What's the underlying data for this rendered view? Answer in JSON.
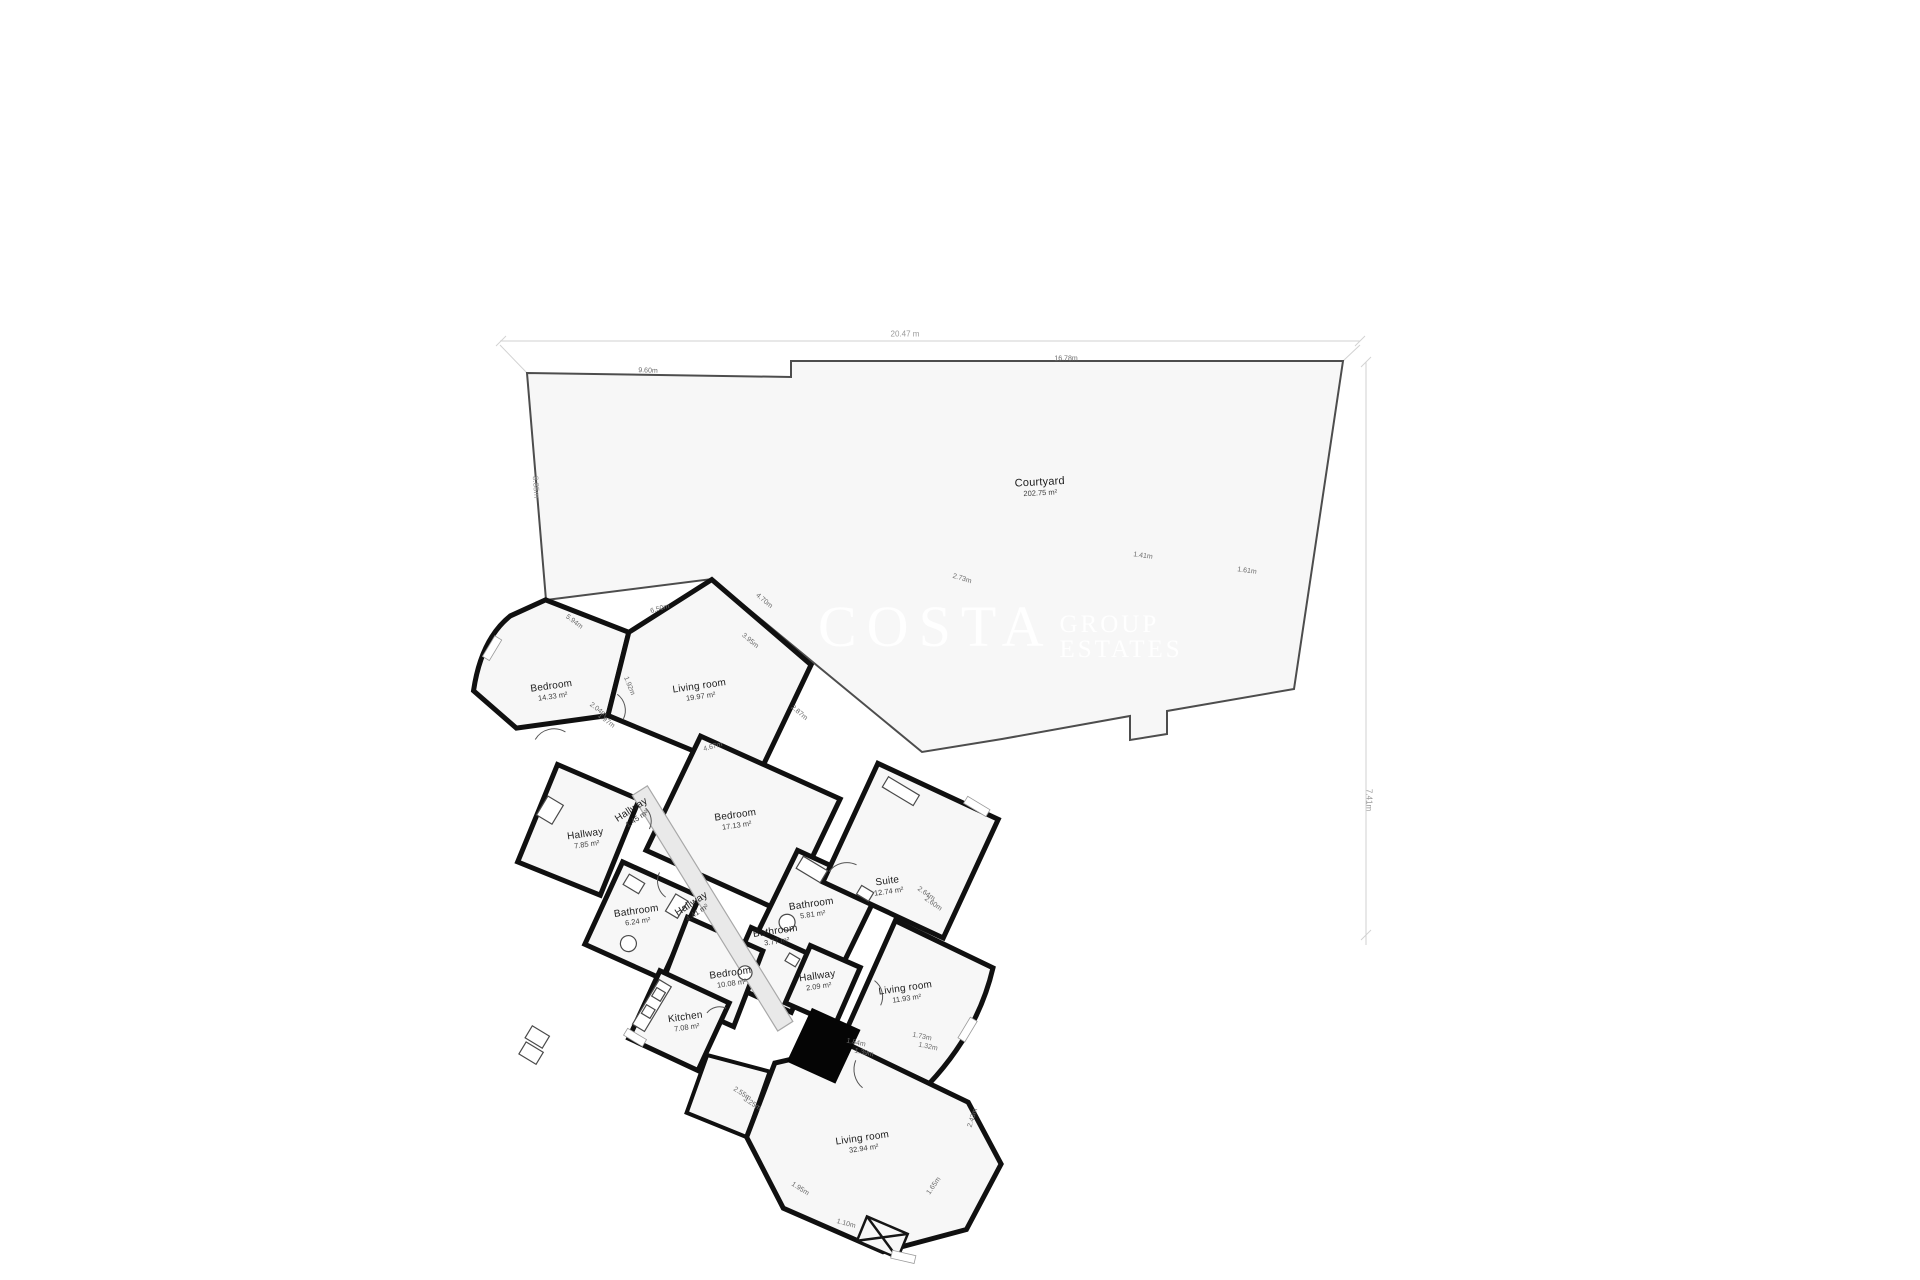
{
  "palette": {
    "background": "#ffffff",
    "plan_fill": "#f7f7f7",
    "wall_color": "#101010",
    "courtyard_outline": "#4d4d4d",
    "corridor_fill": "#e9e9e9",
    "dim_line": "#d2d2d2",
    "watermark_color": "#ffffff"
  },
  "watermark": {
    "line1": "COSTA",
    "line2": "GROUP",
    "line3": "ESTATES"
  },
  "rooms": [
    {
      "name": "Courtyard",
      "area": "202.75 m²",
      "x": 1040,
      "y": 487,
      "rot": -3,
      "big": true
    },
    {
      "name": "Bedroom",
      "area": "14.33 m²",
      "x": 552,
      "y": 691,
      "rot": -8,
      "big": false
    },
    {
      "name": "Living room",
      "area": "19.97 m²",
      "x": 700,
      "y": 691,
      "rot": -8,
      "big": false
    },
    {
      "name": "Hallway",
      "area": "7.85 m²",
      "x": 586,
      "y": 839,
      "rot": -8,
      "big": false
    },
    {
      "name": "Hallway",
      "area": "1.45 m²",
      "x": 634,
      "y": 814,
      "rot": -33,
      "big": false
    },
    {
      "name": "Bedroom",
      "area": "17.13 m²",
      "x": 736,
      "y": 820,
      "rot": -8,
      "big": false
    },
    {
      "name": "Bathroom",
      "area": "6.24 m²",
      "x": 637,
      "y": 916,
      "rot": -8,
      "big": false
    },
    {
      "name": "Hallway",
      "area": "4.41 m²",
      "x": 694,
      "y": 908,
      "rot": -33,
      "big": false
    },
    {
      "name": "Bathroom",
      "area": "5.81 m²",
      "x": 812,
      "y": 909,
      "rot": -8,
      "big": false
    },
    {
      "name": "Bathroom",
      "area": "3.77 m²",
      "x": 776,
      "y": 936,
      "rot": -8,
      "big": false
    },
    {
      "name": "Suite",
      "area": "12.74 m²",
      "x": 888,
      "y": 886,
      "rot": -8,
      "big": false
    },
    {
      "name": "Bedroom",
      "area": "10.08 m²",
      "x": 731,
      "y": 978,
      "rot": -8,
      "big": false
    },
    {
      "name": "Hallway",
      "area": "2.09 m²",
      "x": 818,
      "y": 981,
      "rot": -8,
      "big": false
    },
    {
      "name": "Living room",
      "area": "11.93 m²",
      "x": 906,
      "y": 993,
      "rot": -8,
      "big": false
    },
    {
      "name": "Kitchen",
      "area": "7.08 m²",
      "x": 686,
      "y": 1022,
      "rot": -8,
      "big": false
    },
    {
      "name": "Living room",
      "area": "32.94 m²",
      "x": 863,
      "y": 1143,
      "rot": -8,
      "big": false
    }
  ],
  "dimensions": [
    {
      "text": "20.47 m",
      "x": 905,
      "y": 334,
      "rot": 0,
      "outer": true
    },
    {
      "text": "16.78m",
      "x": 1066,
      "y": 359,
      "rot": 0,
      "outer": false
    },
    {
      "text": "9.60m",
      "x": 648,
      "y": 371,
      "rot": 2,
      "outer": false
    },
    {
      "text": "8.85m",
      "x": 536,
      "y": 487,
      "rot": 86,
      "outer": true
    },
    {
      "text": "7.41m",
      "x": 1369,
      "y": 800,
      "rot": 90,
      "outer": true
    },
    {
      "text": "1.61m",
      "x": 1247,
      "y": 571,
      "rot": 8,
      "outer": false
    },
    {
      "text": "1.41m",
      "x": 1143,
      "y": 556,
      "rot": 8,
      "outer": false
    },
    {
      "text": "2.73m",
      "x": 962,
      "y": 579,
      "rot": 17,
      "outer": false
    },
    {
      "text": "5.94m",
      "x": 574,
      "y": 622,
      "rot": 37,
      "outer": false
    },
    {
      "text": "6.50m",
      "x": 660,
      "y": 609,
      "rot": -16,
      "outer": false
    },
    {
      "text": "4.70m",
      "x": 764,
      "y": 601,
      "rot": 40,
      "outer": false
    },
    {
      "text": "3.95m",
      "x": 750,
      "y": 641,
      "rot": 40,
      "outer": false
    },
    {
      "text": "4.67m",
      "x": 713,
      "y": 747,
      "rot": -16,
      "outer": false
    },
    {
      "text": "2.87m",
      "x": 799,
      "y": 713,
      "rot": 40,
      "outer": false
    },
    {
      "text": "2.04m",
      "x": 598,
      "y": 710,
      "rot": 37,
      "outer": false
    },
    {
      "text": "1.97m",
      "x": 606,
      "y": 721,
      "rot": 37,
      "outer": false
    },
    {
      "text": "1.92m",
      "x": 629,
      "y": 686,
      "rot": 68,
      "outer": false
    },
    {
      "text": "2.64m",
      "x": 926,
      "y": 894,
      "rot": 35,
      "outer": false
    },
    {
      "text": "2.60m",
      "x": 933,
      "y": 904,
      "rot": 35,
      "outer": false
    },
    {
      "text": "2.55m",
      "x": 742,
      "y": 1094,
      "rot": 33,
      "outer": false
    },
    {
      "text": "3.25m",
      "x": 752,
      "y": 1104,
      "rot": 33,
      "outer": false
    },
    {
      "text": "1.84m",
      "x": 856,
      "y": 1043,
      "rot": 12,
      "outer": false
    },
    {
      "text": "1.39m",
      "x": 864,
      "y": 1053,
      "rot": 12,
      "outer": false
    },
    {
      "text": "1.73m",
      "x": 922,
      "y": 1037,
      "rot": 12,
      "outer": false
    },
    {
      "text": "1.32m",
      "x": 928,
      "y": 1047,
      "rot": 12,
      "outer": false
    },
    {
      "text": "1.95m",
      "x": 800,
      "y": 1189,
      "rot": 33,
      "outer": false
    },
    {
      "text": "1.10m",
      "x": 846,
      "y": 1224,
      "rot": 15,
      "outer": false
    },
    {
      "text": "1.65m",
      "x": 934,
      "y": 1186,
      "rot": -55,
      "outer": false
    },
    {
      "text": "2.43m",
      "x": 973,
      "y": 1118,
      "rot": -72,
      "outer": false
    }
  ]
}
